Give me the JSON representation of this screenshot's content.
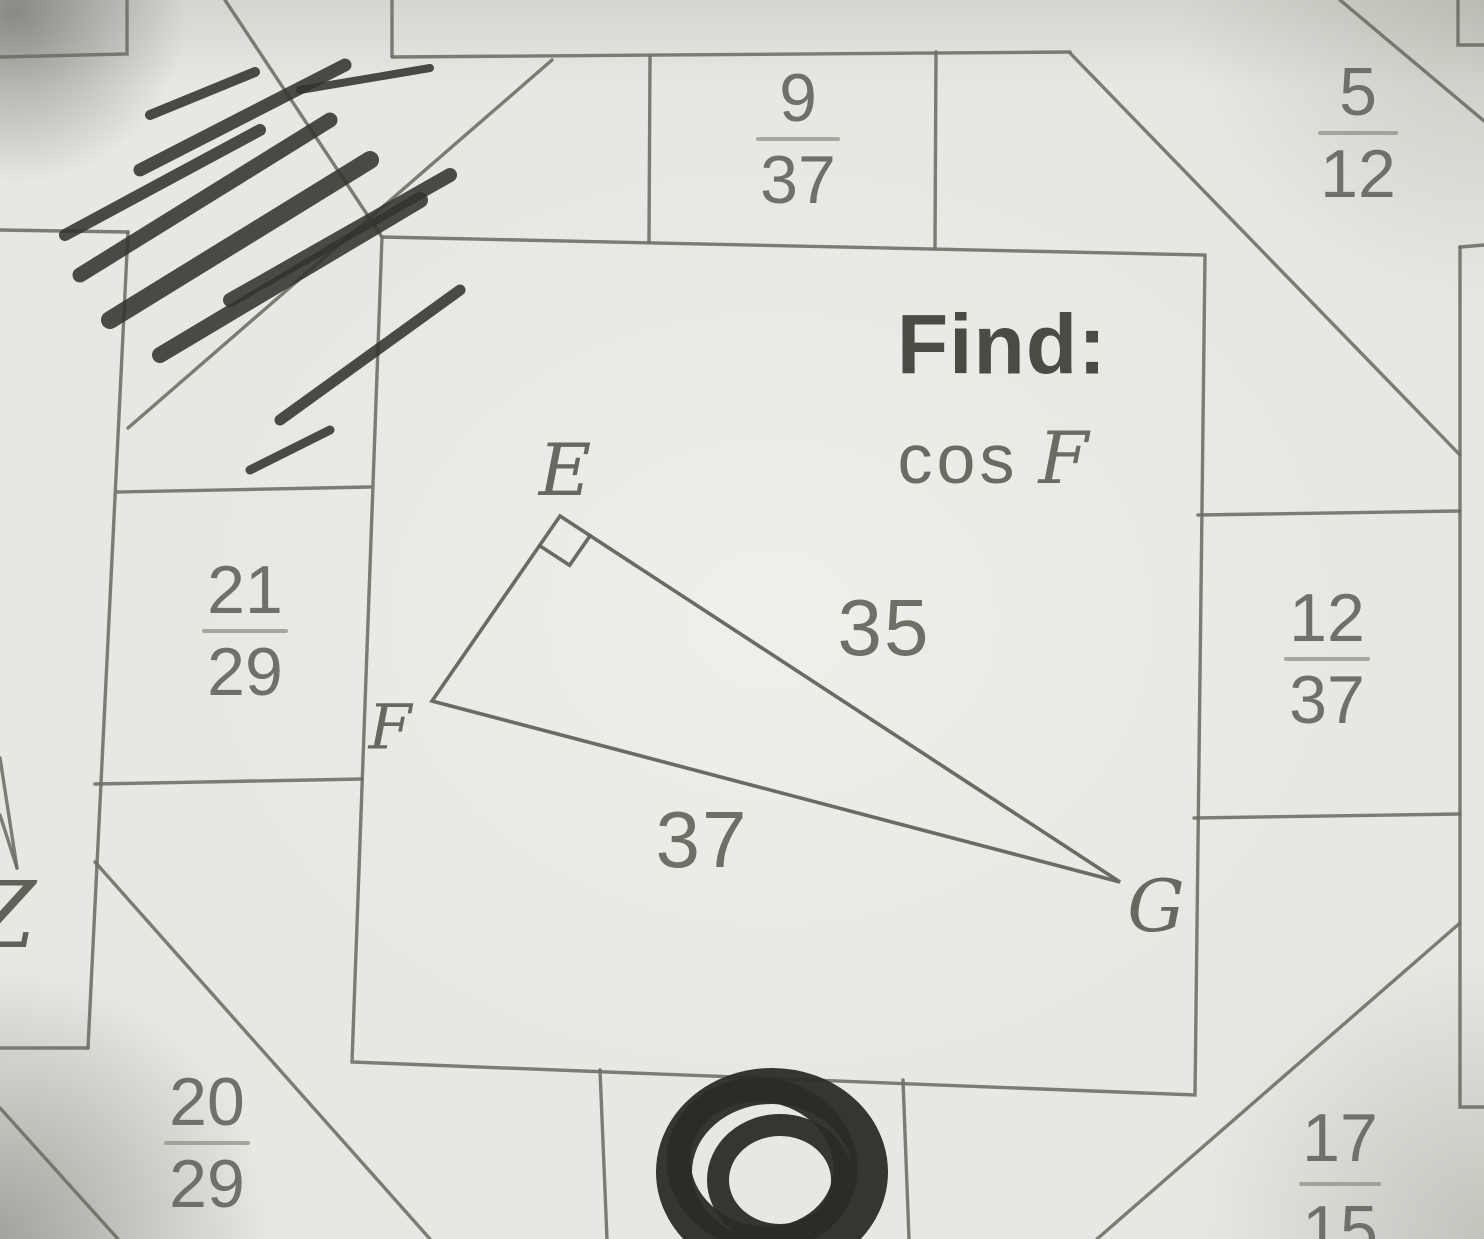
{
  "colors": {
    "paper": "#e8e8e2",
    "line": "#6c6c64",
    "text": "#5c5c54",
    "pencil": "#33332e"
  },
  "problem": {
    "find_label": "Find:",
    "trig_function": "cos",
    "angle_name": "F"
  },
  "triangle": {
    "label_e": "E",
    "label_f": "F",
    "label_g": "G",
    "side_eg": "35",
    "side_fg": "37",
    "right_angle_at": "E"
  },
  "fractions": {
    "top_center": {
      "num": "9",
      "den": "37"
    },
    "top_right": {
      "num": "5",
      "den": "12"
    },
    "mid_left": {
      "num": "21",
      "den": "29"
    },
    "mid_right": {
      "num": "12",
      "den": "37"
    },
    "bottom_left": {
      "num": "20",
      "den": "29"
    },
    "bottom_right": {
      "num": "17",
      "den": "15"
    }
  },
  "stray_letter": "Z"
}
